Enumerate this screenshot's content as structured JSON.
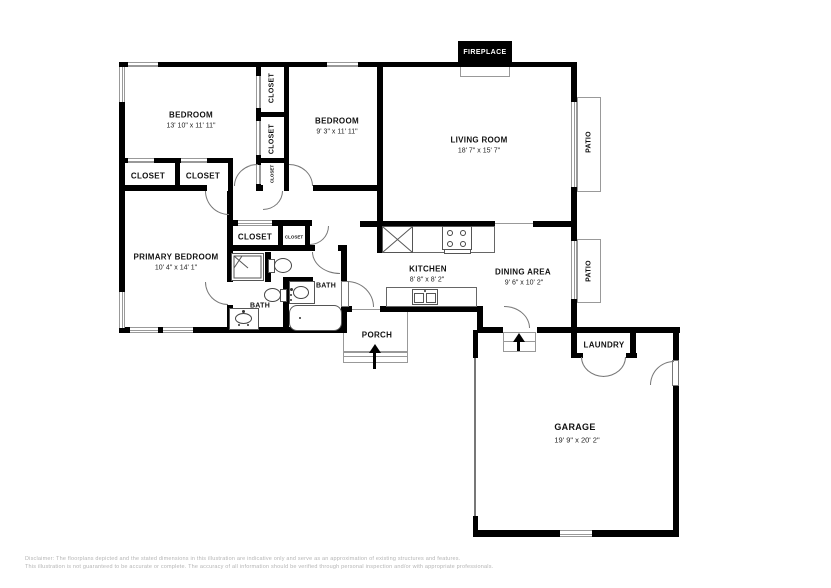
{
  "floorplan": {
    "fireplace": "FIREPLACE",
    "bedroom1": {
      "name": "BEDROOM",
      "dims": "13' 10\" x 11' 11\""
    },
    "bedroom2": {
      "name": "BEDROOM",
      "dims": "9' 3\" x 11' 11\""
    },
    "living": {
      "name": "LIVING ROOM",
      "dims": "18' 7\" x 15' 7\""
    },
    "primary": {
      "name": "PRIMARY BEDROOM",
      "dims": "10' 4\" x 14' 1\""
    },
    "kitchen": {
      "name": "KITCHEN",
      "dims": "8' 8\" x 8' 2\""
    },
    "dining": {
      "name": "DINING AREA",
      "dims": "9' 6\" x 10' 2\""
    },
    "garage": {
      "name": "GARAGE",
      "dims": "19' 9\" x 20' 2\""
    },
    "porch": "PORCH",
    "laundry": "LAUNDRY",
    "bath": "BATH",
    "closet": "CLOSET",
    "patio": "PATIO",
    "colors": {
      "wall": "#000000",
      "thin_line": "#999999",
      "text": "#111111",
      "disclaimer_text": "#b5b5b5"
    }
  },
  "disclaimer": {
    "line1": "Disclaimer: The floorplans depicted and the stated dimensions in this illustration are indicative only and serve as an approximation of existing structures and features.",
    "line2": "This illustration is not guaranteed to be accurate or complete. The accuracy of all information should be verified through personal inspection and/or with appropriate professionals."
  }
}
